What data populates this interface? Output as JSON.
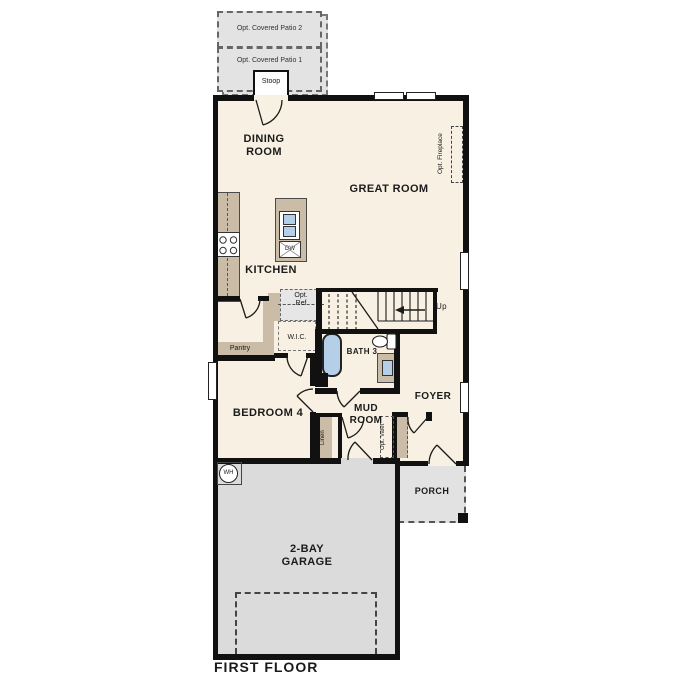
{
  "title": "FIRST FLOOR",
  "colors": {
    "wall": "#111111",
    "floor": "#f8f1e3",
    "cabinet": "#cabca7",
    "garage": "#dbdbdb",
    "patio": "#e3e3e3",
    "porch": "#e2e2e2",
    "blue": "#b5cfe9"
  },
  "labels": {
    "opt_patio_2": "Opt. Covered Patio 2",
    "opt_patio_1": "Opt. Covered Patio 1",
    "stoop": "Stoop",
    "dining": "DINING ROOM",
    "great": "GREAT ROOM",
    "kitchen": "KITCHEN",
    "opt_fireplace": "Opt. Fireplace",
    "opt_ref": "Opt. Ref",
    "pantry": "Pantry",
    "wic": "W.I.C.",
    "bath3": "BATH 3",
    "up": "Up",
    "dw": "DW",
    "wh": "WH",
    "bedroom4": "BEDROOM 4",
    "mudroom": "MUD ROOM",
    "foyer": "FOYER",
    "linen": "Linen",
    "opt_valet": "Opt. Valet",
    "porch": "PORCH",
    "garage": "2-BAY GARAGE",
    "first_floor": "FIRST FLOOR"
  }
}
